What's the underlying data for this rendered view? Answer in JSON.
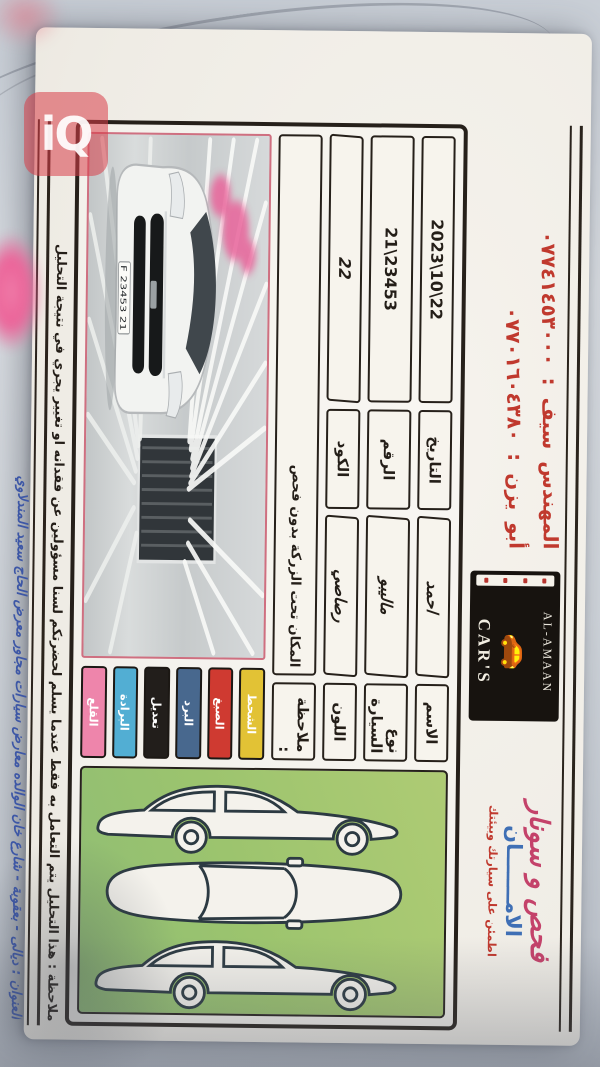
{
  "colors": {
    "red_ink": "#c0392e",
    "blue_ink": "#3d57a6",
    "title_pink": "#c4426a",
    "title_blue": "#3f6fb5",
    "paper": "#f2efe8",
    "diagram_green": "#9cc46e"
  },
  "watermark": {
    "text": "iQ"
  },
  "header": {
    "phones": [
      {
        "label": "المهندس سيف :",
        "number": "٠٧٧٤١٤٥٣٠٠٠"
      },
      {
        "label": "أبو يزن :",
        "number": "٠٧٧٠١٦٠٤٣٨٠"
      }
    ],
    "logo": {
      "top": "AL-AMAAN",
      "car_icon": "🚗",
      "bottom": "CAR'S"
    },
    "letterhead": {
      "title": "فحص و سونار",
      "brand": "الامـــــــان",
      "subtitle": "اطمئن على سيارتك وبيئتك"
    }
  },
  "form": {
    "fields": [
      {
        "label": "الاسم",
        "value": "احمد"
      },
      {
        "label": "التاريخ",
        "value": "22\\10\\2023"
      },
      {
        "label": "نوع السيارة",
        "value": "ماليبو"
      },
      {
        "label": "الرقم",
        "value": "23453\\21"
      },
      {
        "label": "اللون",
        "value": "رصاصي"
      },
      {
        "label": "الكود",
        "value": "22"
      }
    ],
    "note_label": "ملاحظة :",
    "note_value": "المكان تحت الزركة بدون فحص",
    "legend": [
      {
        "label": "الشحط",
        "color": "#e2c235"
      },
      {
        "label": "الصبغ",
        "color": "#cf3a31"
      },
      {
        "label": "البرد",
        "color": "#48688e"
      },
      {
        "label": "تعديل",
        "color": "#221e1b"
      },
      {
        "label": "البرادة",
        "color": "#52aed3"
      },
      {
        "label": "القلع",
        "color": "#ee85ab"
      }
    ],
    "plate": "21 F 23453"
  },
  "footer": {
    "analysis_note": "ملاحظة : هذا التحليل يتم التعامل به فقط عندما يسلم لحضرتكم لسنا مسؤولين عن فقدانه او تغيير يجري في نتيجة التحليل",
    "address": "العنوان : ديالى - بعقوبة - شارع خان الوالده معارض سيارات مجاور معرض الحاج سعيد المندلاوي"
  }
}
